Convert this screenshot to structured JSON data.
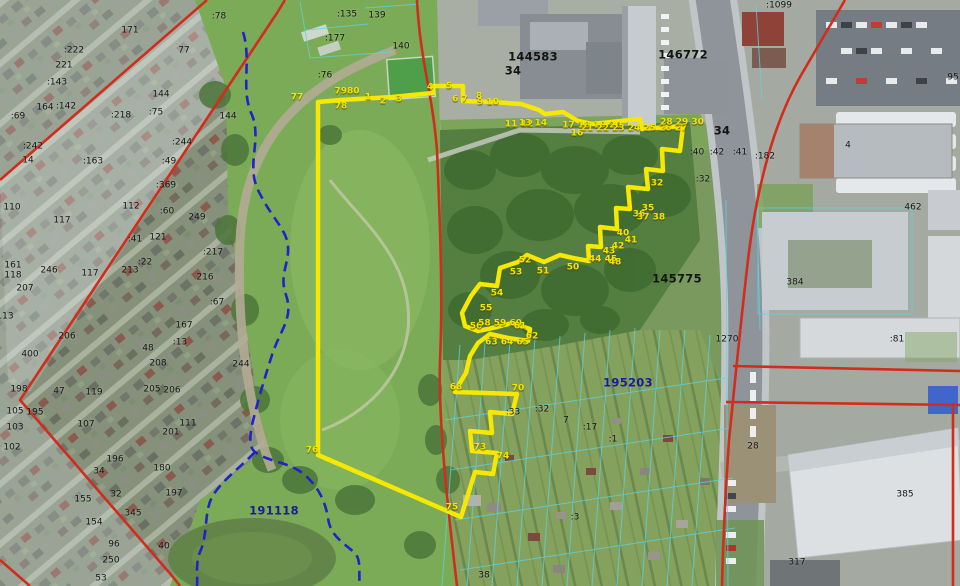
{
  "map": {
    "kind": "cadastral-satellite-map",
    "colors": {
      "boundary_red": "#d22c1d",
      "parcel_yellow": "#f6e800",
      "zone_blue_dashed": "#2222c8",
      "cadastral_cyan": "#5cd4e2",
      "label_black": "#141414",
      "label_yellow": "#f4e400",
      "label_navy": "#1b1b9e"
    },
    "labels": {
      "quarters": [
        {
          "text": "144583",
          "x": 533,
          "y": 57,
          "kind": "black"
        },
        {
          "text": "34",
          "x": 513,
          "y": 71,
          "kind": "black"
        },
        {
          "text": "146772",
          "x": 683,
          "y": 55,
          "kind": "black"
        },
        {
          "text": "34",
          "x": 722,
          "y": 131,
          "kind": "black"
        },
        {
          "text": "145775",
          "x": 677,
          "y": 279,
          "kind": "black"
        },
        {
          "text": "195203",
          "x": 628,
          "y": 383,
          "kind": "navy"
        },
        {
          "text": "191118",
          "x": 274,
          "y": 511,
          "kind": "navy"
        }
      ],
      "parcels": [
        {
          "text": ":78",
          "x": 219,
          "y": 17
        },
        {
          "text": "171",
          "x": 130,
          "y": 31
        },
        {
          "text": "77",
          "x": 184,
          "y": 51
        },
        {
          "text": ":222",
          "x": 74,
          "y": 51
        },
        {
          "text": "221",
          "x": 64,
          "y": 66
        },
        {
          "text": ":143",
          "x": 57,
          "y": 83
        },
        {
          "text": "144",
          "x": 161,
          "y": 95
        },
        {
          "text": "164",
          "x": 45,
          "y": 108
        },
        {
          "text": ":142",
          "x": 66,
          "y": 107
        },
        {
          "text": ":218",
          "x": 121,
          "y": 116
        },
        {
          "text": ":75",
          "x": 156,
          "y": 113
        },
        {
          "text": "144",
          "x": 228,
          "y": 117
        },
        {
          "text": ":69",
          "x": 18,
          "y": 117
        },
        {
          "text": ":244",
          "x": 182,
          "y": 143
        },
        {
          "text": ":242",
          "x": 33,
          "y": 147
        },
        {
          "text": "14",
          "x": 28,
          "y": 161
        },
        {
          "text": ":163",
          "x": 93,
          "y": 162
        },
        {
          "text": ":49",
          "x": 169,
          "y": 162
        },
        {
          "text": ":369",
          "x": 166,
          "y": 186
        },
        {
          "text": "112",
          "x": 131,
          "y": 207
        },
        {
          "text": "110",
          "x": 12,
          "y": 208
        },
        {
          "text": ":60",
          "x": 167,
          "y": 212
        },
        {
          "text": "249",
          "x": 197,
          "y": 218
        },
        {
          "text": "117",
          "x": 62,
          "y": 221
        },
        {
          "text": "121",
          "x": 158,
          "y": 238
        },
        {
          "text": ":41",
          "x": 135,
          "y": 240
        },
        {
          "text": ":217",
          "x": 213,
          "y": 253
        },
        {
          "text": ":22",
          "x": 145,
          "y": 263
        },
        {
          "text": "213",
          "x": 130,
          "y": 271
        },
        {
          "text": "161",
          "x": 13,
          "y": 266
        },
        {
          "text": "118",
          "x": 13,
          "y": 276
        },
        {
          "text": "246",
          "x": 49,
          "y": 271
        },
        {
          "text": "117",
          "x": 90,
          "y": 274
        },
        {
          "text": "216",
          "x": 205,
          "y": 278
        },
        {
          "text": "207",
          "x": 25,
          "y": 289
        },
        {
          "text": ":67",
          "x": 217,
          "y": 303
        },
        {
          "text": "113",
          "x": 5,
          "y": 317
        },
        {
          "text": "206",
          "x": 67,
          "y": 337
        },
        {
          "text": "167",
          "x": 184,
          "y": 326
        },
        {
          "text": ":13",
          "x": 180,
          "y": 343
        },
        {
          "text": "48",
          "x": 148,
          "y": 349
        },
        {
          "text": "400",
          "x": 30,
          "y": 355
        },
        {
          "text": "208",
          "x": 158,
          "y": 364
        },
        {
          "text": "244",
          "x": 241,
          "y": 365
        },
        {
          "text": "205",
          "x": 152,
          "y": 390
        },
        {
          "text": "206",
          "x": 172,
          "y": 391
        },
        {
          "text": "198",
          "x": 19,
          "y": 390
        },
        {
          "text": "47",
          "x": 59,
          "y": 392
        },
        {
          "text": "119",
          "x": 94,
          "y": 393
        },
        {
          "text": "105",
          "x": 15,
          "y": 412
        },
        {
          "text": "195",
          "x": 35,
          "y": 413
        },
        {
          "text": "103",
          "x": 15,
          "y": 428
        },
        {
          "text": "102",
          "x": 12,
          "y": 448
        },
        {
          "text": "107",
          "x": 86,
          "y": 425
        },
        {
          "text": "111",
          "x": 188,
          "y": 424
        },
        {
          "text": "201",
          "x": 171,
          "y": 433
        },
        {
          "text": "196",
          "x": 115,
          "y": 460
        },
        {
          "text": "34",
          "x": 99,
          "y": 472
        },
        {
          "text": "180",
          "x": 162,
          "y": 469
        },
        {
          "text": "32",
          "x": 116,
          "y": 495
        },
        {
          "text": "197",
          "x": 174,
          "y": 494
        },
        {
          "text": "155",
          "x": 83,
          "y": 500
        },
        {
          "text": "154",
          "x": 94,
          "y": 523
        },
        {
          "text": "345",
          "x": 133,
          "y": 514
        },
        {
          "text": "96",
          "x": 114,
          "y": 545
        },
        {
          "text": "40",
          "x": 164,
          "y": 547
        },
        {
          "text": "250",
          "x": 111,
          "y": 561
        },
        {
          "text": "53",
          "x": 101,
          "y": 579
        },
        {
          "text": ":135",
          "x": 347,
          "y": 15
        },
        {
          "text": "139",
          "x": 377,
          "y": 16
        },
        {
          "text": ":177",
          "x": 335,
          "y": 39
        },
        {
          "text": "140",
          "x": 401,
          "y": 47
        },
        {
          "text": ":76",
          "x": 325,
          "y": 76
        },
        {
          "text": ":1099",
          "x": 779,
          "y": 6
        },
        {
          "text": ":182",
          "x": 765,
          "y": 157
        },
        {
          "text": ":40",
          "x": 697,
          "y": 153
        },
        {
          "text": ":42",
          "x": 717,
          "y": 153
        },
        {
          "text": ":41",
          "x": 740,
          "y": 153
        },
        {
          "text": ":32",
          "x": 703,
          "y": 180
        },
        {
          "text": "462",
          "x": 913,
          "y": 208
        },
        {
          "text": "95",
          "x": 953,
          "y": 78
        },
        {
          "text": "4",
          "x": 848,
          "y": 146
        },
        {
          "text": "384",
          "x": 795,
          "y": 283
        },
        {
          "text": ":81",
          "x": 897,
          "y": 340
        },
        {
          "text": "1270",
          "x": 727,
          "y": 340
        },
        {
          "text": ":33",
          "x": 513,
          "y": 413
        },
        {
          "text": ":32",
          "x": 542,
          "y": 410
        },
        {
          "text": "7",
          "x": 566,
          "y": 421
        },
        {
          "text": ":17",
          "x": 590,
          "y": 428
        },
        {
          "text": ":1",
          "x": 613,
          "y": 440
        },
        {
          "text": ":3",
          "x": 575,
          "y": 518
        },
        {
          "text": "38",
          "x": 484,
          "y": 576
        },
        {
          "text": "28",
          "x": 753,
          "y": 447
        },
        {
          "text": "385",
          "x": 905,
          "y": 495
        },
        {
          "text": "317",
          "x": 797,
          "y": 563
        }
      ],
      "vertices": [
        {
          "text": "77",
          "x": 297,
          "y": 98
        },
        {
          "text": "7980",
          "x": 347,
          "y": 92
        },
        {
          "text": "78",
          "x": 341,
          "y": 107
        },
        {
          "text": "1",
          "x": 368,
          "y": 98
        },
        {
          "text": "2",
          "x": 383,
          "y": 102
        },
        {
          "text": "3",
          "x": 399,
          "y": 100
        },
        {
          "text": "4",
          "x": 430,
          "y": 88
        },
        {
          "text": "5",
          "x": 449,
          "y": 87
        },
        {
          "text": "6 7",
          "x": 460,
          "y": 100
        },
        {
          "text": "8",
          "x": 479,
          "y": 97
        },
        {
          "text": "9 10",
          "x": 488,
          "y": 103
        },
        {
          "text": "11 12",
          "x": 519,
          "y": 125
        },
        {
          "text": "13 14",
          "x": 533,
          "y": 124
        },
        {
          "text": "16",
          "x": 577,
          "y": 134
        },
        {
          "text": "17 18 19 20",
          "x": 592,
          "y": 126
        },
        {
          "text": "21 22 23 24 25 26 27",
          "x": 634,
          "y": 129
        },
        {
          "text": "28 29 30",
          "x": 682,
          "y": 123
        },
        {
          "text": "32",
          "x": 657,
          "y": 184
        },
        {
          "text": "35",
          "x": 648,
          "y": 209
        },
        {
          "text": "36",
          "x": 639,
          "y": 215
        },
        {
          "text": "37 38",
          "x": 651,
          "y": 218
        },
        {
          "text": "40",
          "x": 623,
          "y": 234
        },
        {
          "text": "41",
          "x": 631,
          "y": 241
        },
        {
          "text": "42",
          "x": 618,
          "y": 247
        },
        {
          "text": "43",
          "x": 609,
          "y": 252
        },
        {
          "text": "44 45",
          "x": 603,
          "y": 260
        },
        {
          "text": "48",
          "x": 615,
          "y": 263
        },
        {
          "text": "50",
          "x": 573,
          "y": 268
        },
        {
          "text": "51",
          "x": 543,
          "y": 272
        },
        {
          "text": "52",
          "x": 525,
          "y": 261
        },
        {
          "text": "53",
          "x": 516,
          "y": 273
        },
        {
          "text": "54",
          "x": 497,
          "y": 294
        },
        {
          "text": "55",
          "x": 486,
          "y": 309
        },
        {
          "text": "56",
          "x": 476,
          "y": 327
        },
        {
          "text": "58 59 60",
          "x": 500,
          "y": 324
        },
        {
          "text": "61",
          "x": 520,
          "y": 327
        },
        {
          "text": "62",
          "x": 532,
          "y": 337
        },
        {
          "text": "63 64 65",
          "x": 507,
          "y": 343
        },
        {
          "text": "68",
          "x": 456,
          "y": 388
        },
        {
          "text": "70",
          "x": 518,
          "y": 389
        },
        {
          "text": "73",
          "x": 480,
          "y": 448
        },
        {
          "text": "74",
          "x": 503,
          "y": 457
        },
        {
          "text": "75",
          "x": 452,
          "y": 508
        },
        {
          "text": "76",
          "x": 312,
          "y": 451
        }
      ]
    }
  }
}
